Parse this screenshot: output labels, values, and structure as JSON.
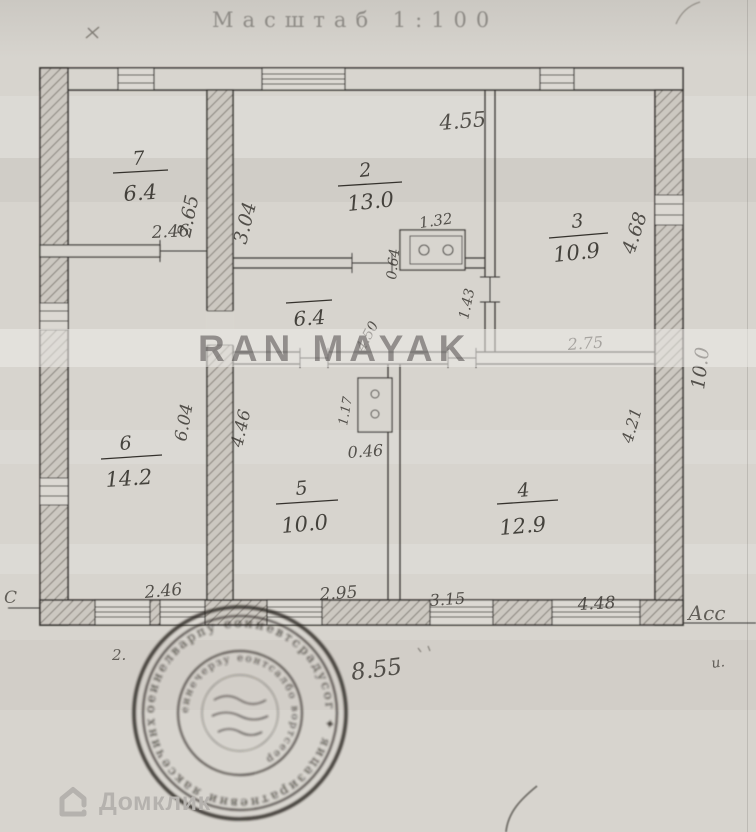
{
  "page": {
    "title": "Масштаб 1:100",
    "watermark": "RAN MAYAK",
    "brand": "Домклик"
  },
  "plan": {
    "rooms": [
      {
        "num": "7",
        "area": "6.4"
      },
      {
        "num": "2",
        "area": "13.0"
      },
      {
        "num": "3",
        "area": "10.9"
      },
      {
        "num": "6",
        "area": "14.2"
      },
      {
        "num": "5",
        "area": "10.0"
      },
      {
        "num": "4",
        "area": "12.9"
      }
    ],
    "hall_area": "6.4",
    "dims": {
      "room2_top": "4.55",
      "room7_height": "2.65",
      "room2_left_height": "3.04",
      "room3_right": "4.68",
      "house_right": "10.0",
      "room7_door": "2.46",
      "stove_depth": "0.64",
      "stove_width": "1.32",
      "passage": "1.43",
      "hall_width": "4.50",
      "room3_bottom": "2.75",
      "room5_height": "4.46",
      "wall_mid_height": "6.04",
      "room4_height": "4.21",
      "stove2_height": "1.17",
      "stove2_width": "0.46",
      "bottom_w1": "2.46",
      "bottom_w2": "2.95",
      "bottom_w3": "3.15",
      "bottom_w4": "4.48",
      "house_width": "8.55"
    },
    "annotations": {
      "right_label": "Асс",
      "right_label2": "и.",
      "left_edge": "С",
      "near_stamp": "2."
    }
  },
  "stamp": {
    "type": "round-seal",
    "legibility": "illegible",
    "outer_ring_text_sim": "оеинелварпу еонневтсрадусог ✦ яицазиратневни яаксечинхет ✦",
    "inner_ring_text_sim": "еинечерзу еонтсалбо вортсеер"
  },
  "colors": {
    "paper": "#d8d5cf",
    "ink": "#3a3733",
    "stamp_ink": "#26231f",
    "watermark_text": "#484442",
    "brand_gray": "#b5b2ae"
  }
}
